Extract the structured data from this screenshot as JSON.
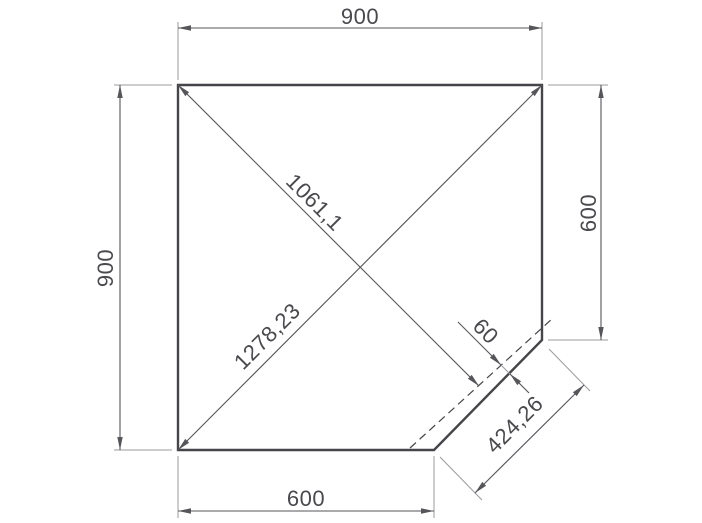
{
  "drawing": {
    "dimensions": {
      "top_width": "900",
      "left_height": "900",
      "right_height": "600",
      "bottom_width": "600",
      "diagonal_to_chamfer": "1061,1",
      "diagonal_full": "1278,23",
      "chamfer_offset": "60",
      "chamfer_length": "424,26"
    },
    "colors": {
      "outline": "#46464a",
      "dimension_line": "#55555a",
      "extension_line": "#9b9b9e",
      "text": "#4a4a4e",
      "background": "#ffffff"
    }
  }
}
